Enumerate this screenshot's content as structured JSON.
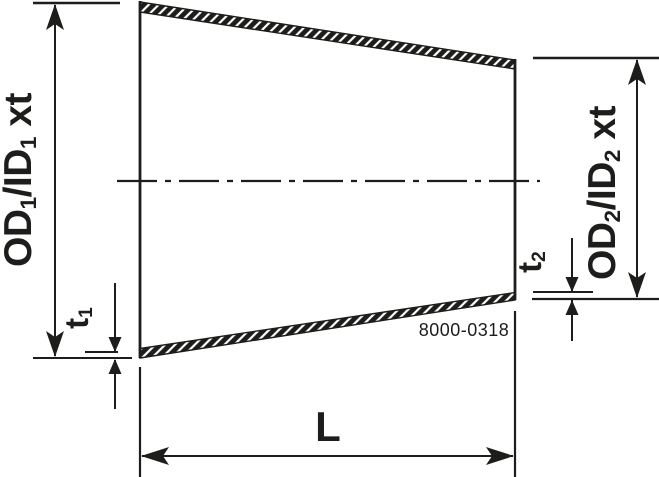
{
  "drawing": {
    "part_number": "8000-0318",
    "colors": {
      "line": "#1d1d1b",
      "background": "#ffffff"
    },
    "labels": {
      "left_diameter": {
        "prefix": "OD",
        "sub1": "1",
        "mid": "/ID",
        "sub2": "1",
        "suffix": " xt"
      },
      "right_diameter": {
        "prefix": "OD",
        "sub1": "2",
        "mid": "/ID",
        "sub2": "2",
        "suffix": " xt"
      },
      "left_thickness": {
        "prefix": "t",
        "sub": "1"
      },
      "right_thickness": {
        "prefix": "t",
        "sub": "2"
      },
      "length": "L"
    }
  }
}
